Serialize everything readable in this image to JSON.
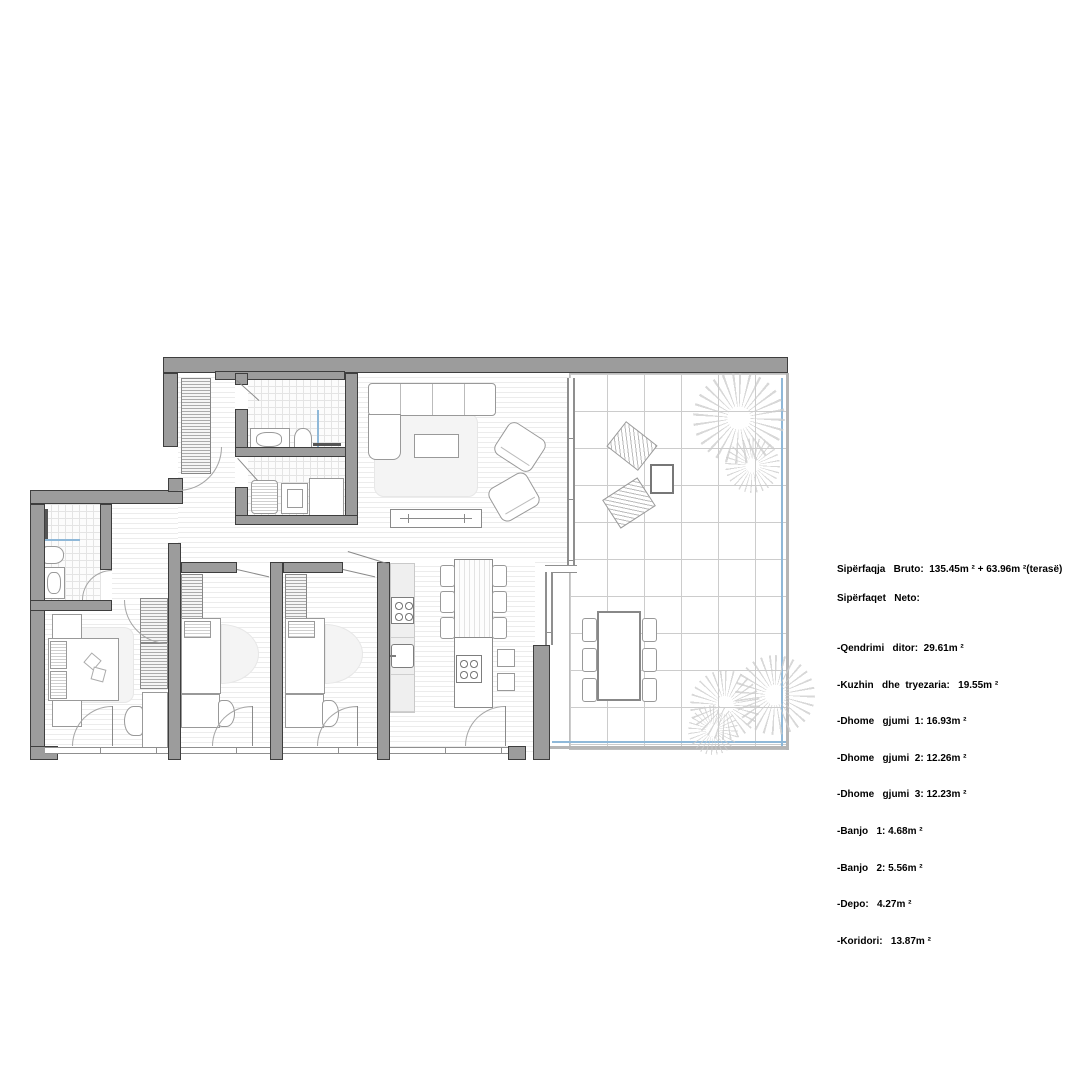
{
  "legend": {
    "line_bruto": "Sipërfaqja   Bruto:  135.45m ² + 63.96m ²(terasë)",
    "line_neto": "Sipërfaqet   Neto:",
    "rooms": [
      "-Qendrimi   ditor:  29.61m ²",
      "-Kuzhin   dhe  tryezaria:   19.55m ²",
      "-Dhome   gjumi  1: 16.93m ²",
      "-Dhome   gjumi  2: 12.26m ²",
      "-Dhome   gjumi  3: 12.23m ²",
      "-Banjo   1: 4.68m ²",
      "-Banjo   2: 5.56m ²",
      "-Depo:   4.27m ²",
      "-Koridori:   13.87m ²"
    ]
  },
  "colors": {
    "wall": "#9c9c9c",
    "wall_outline": "#3e3e3e",
    "floor_line": "#ececec",
    "tile_line": "#e4e4e4",
    "terrace_grid": "#cccccc",
    "accent_blue": "#8fb8d8",
    "furniture": "#999999",
    "furniture_dark": "#777777",
    "rug": "#f4f4f4",
    "plant": "#cccccc",
    "counter": "#efefef",
    "dark_fixture": "#555555",
    "text": "#000000"
  }
}
